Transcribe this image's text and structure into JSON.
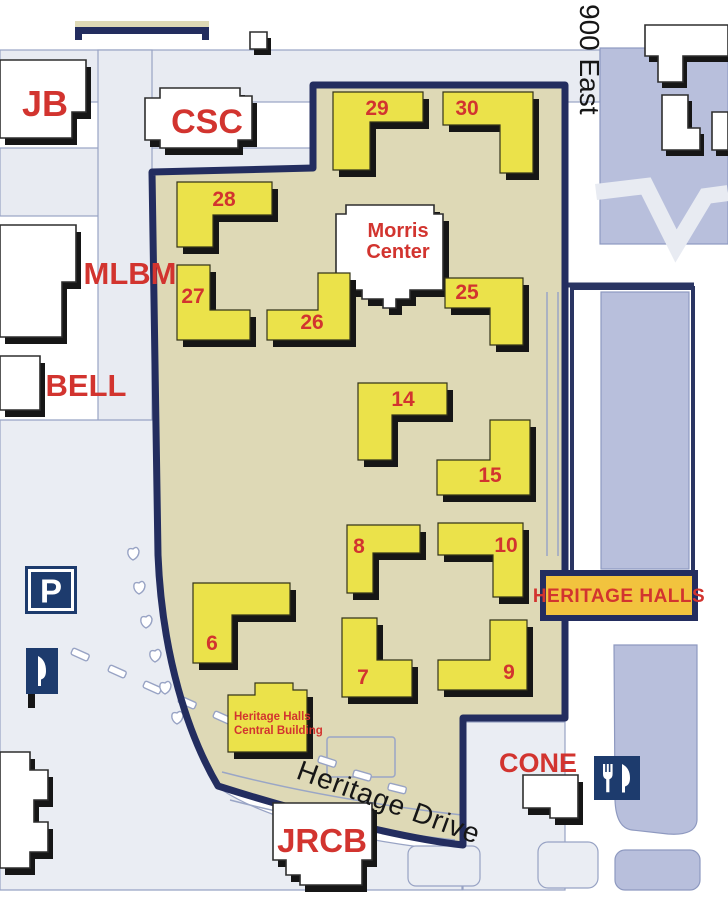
{
  "map": {
    "sign_label": "HERITAGE HALLS",
    "streets": {
      "east": "900 East",
      "drive": "Heritage Drive"
    },
    "buildings": {
      "jb": "JB",
      "csc": "CSC",
      "mlbm": "MLBM",
      "bell": "BELL",
      "jrcb": "JRCB",
      "cone": "CONE",
      "morris_1": "Morris",
      "morris_2": "Center",
      "central_1": "Heritage Halls",
      "central_2": "Central Building"
    },
    "halls": [
      {
        "label": "29"
      },
      {
        "label": "30"
      },
      {
        "label": "28"
      },
      {
        "label": "27"
      },
      {
        "label": "26"
      },
      {
        "label": "25"
      },
      {
        "label": "14"
      },
      {
        "label": "15"
      },
      {
        "label": "8"
      },
      {
        "label": "10"
      },
      {
        "label": "6"
      },
      {
        "label": "7"
      },
      {
        "label": "9"
      }
    ],
    "icons": {
      "parking": "P",
      "dining": "fork-and-knife"
    },
    "colors": {
      "precinct_fill": "#ded9b6",
      "hall_fill": "#ebe24a",
      "boundary_navy": "#232d5f",
      "label_red": "#d2342f",
      "street_fill": "#e8ebf2",
      "block_lavender": "#b8bfdc",
      "sign_fill": "#f2c33e",
      "icon_navy": "#1d3b6d"
    }
  }
}
